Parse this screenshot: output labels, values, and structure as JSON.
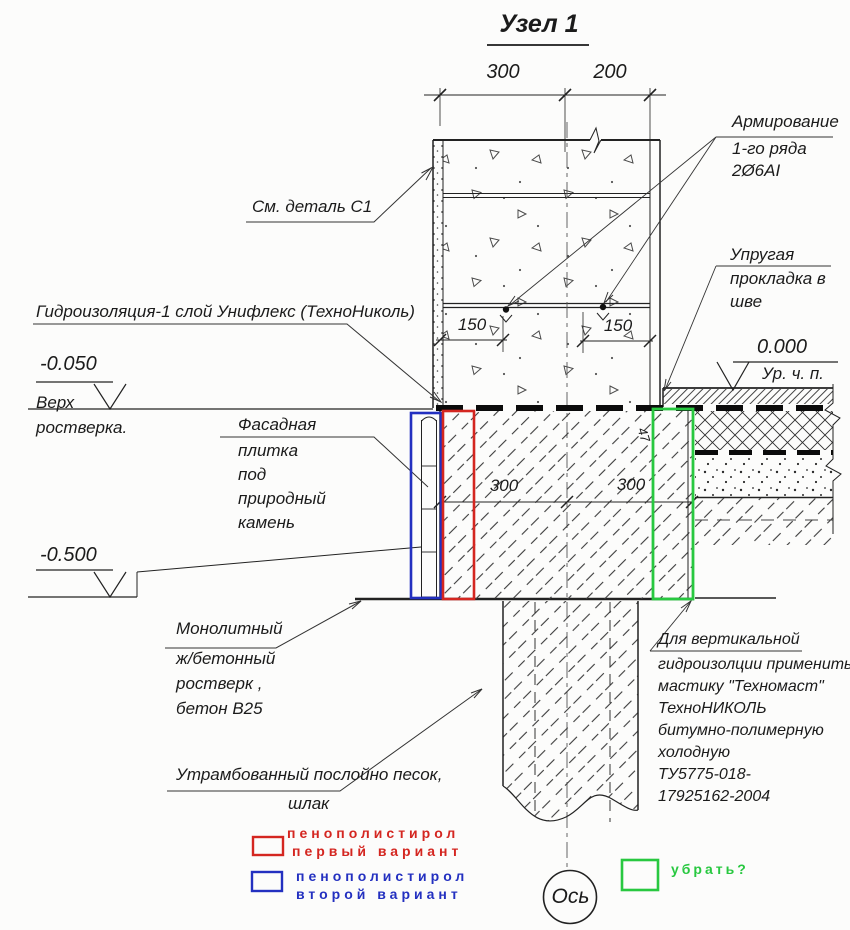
{
  "title": "Узел 1",
  "dimensions": {
    "top_left": "300",
    "top_right": "200",
    "wall_left": "150",
    "wall_right": "150",
    "grillage_left": "300",
    "grillage_right": "300",
    "diagonal": "47"
  },
  "elevations": {
    "floor": "0.000",
    "floor_sub": "Ур. ч. п.",
    "grillage_top": "-0.050",
    "grillage_top_sub1": "Верх",
    "grillage_top_sub2": "ростверка.",
    "grillage_bottom": "-0.500"
  },
  "annotations": {
    "see_detail": "См. деталь С1",
    "waterproofing": "Гидроизоляция-1 слой Унифлекс (ТехноНиколь)",
    "reinforcement": [
      "Армирование",
      "1-го ряда",
      "2Ø6АI"
    ],
    "elastic_gasket": [
      "Упругая",
      "прокладка в",
      "шве"
    ],
    "facade_tile": [
      "Фасадная",
      "плитка",
      "под",
      "природный",
      "камень"
    ],
    "monolithic": [
      "Монолитный",
      "ж/бетонный",
      "ростверк ,",
      "бетон В25"
    ],
    "compacted": [
      "Утрамбованный послойно песок,",
      "шлак"
    ],
    "vertical_waterproofing": [
      "Для вертикальной",
      "гидроизолции применить",
      "мастику \"Техномаст\"",
      "ТехноНИКОЛЬ",
      "битумно-полимерную",
      "холодную",
      "ТУ5775-018-",
      "17925162-2004"
    ],
    "axis": "Ось"
  },
  "legend": {
    "option1": {
      "color": "#d42620",
      "lines": [
        "пенополистирол",
        "первый вариант"
      ]
    },
    "option2": {
      "color": "#2330c0",
      "lines": [
        "пенополистирол",
        "второй вариант"
      ]
    },
    "remove": {
      "color": "#28c840",
      "label": "убрать?"
    }
  },
  "colors": {
    "red": "#d42620",
    "blue": "#2330c0",
    "green": "#28c840",
    "line": "#222222"
  }
}
